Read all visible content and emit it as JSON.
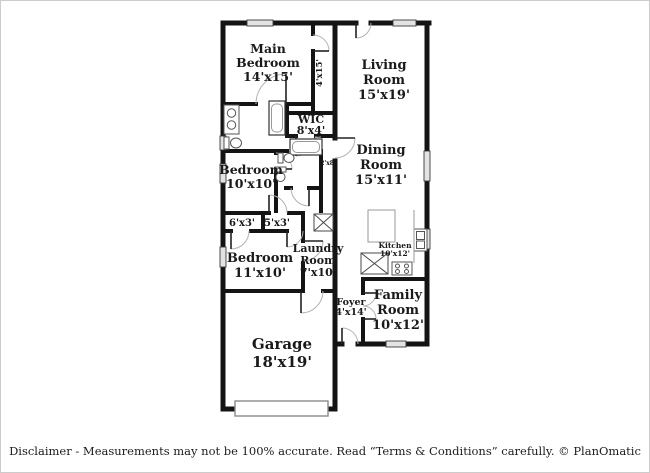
{
  "rooms": {
    "main_bedroom": {
      "line1": "Main",
      "line2": "Bedroom",
      "dims": "14'x15'"
    },
    "hall_top": {
      "dims": "4'x15'"
    },
    "living": {
      "line1": "Living",
      "line2": "Room",
      "dims": "15'x19'"
    },
    "wic": {
      "line1": "WIC",
      "dims": "8'x4'"
    },
    "hall_mid": {
      "dims": "2'x8'"
    },
    "dining": {
      "line1": "Dining",
      "line2": "Room",
      "dims": "15'x11'"
    },
    "bedroom2": {
      "line1": "Bedroom",
      "dims": "10'x10'"
    },
    "closet1": {
      "dims": "6'x3'"
    },
    "closet2": {
      "dims": "5'x3'"
    },
    "bedroom3": {
      "line1": "Bedroom",
      "dims": "11'x10'"
    },
    "laundry": {
      "line1": "Laundry",
      "line2": "Room",
      "dims": "7'x10'"
    },
    "kitchen": {
      "line1": "Kitchen",
      "dims": "10'x12'"
    },
    "foyer": {
      "line1": "Foyer",
      "dims": "4'x14'"
    },
    "family": {
      "line1": "Family",
      "line2": "Room",
      "dims": "10'x12'"
    },
    "garage": {
      "line1": "Garage",
      "dims": "18'x19'"
    }
  },
  "fixtures": [
    "vanity-double-sink",
    "toilet",
    "bathtub",
    "bathtub",
    "pedestal-sink",
    "toilet",
    "utility-closet",
    "kitchen-island",
    "pantry-closet",
    "stove",
    "kitchen-sink",
    "garage-door",
    "front-door"
  ],
  "colors": {
    "wall": "#141414",
    "window": "#e3e3e3",
    "fixture": "#555555",
    "arc": "#b3b3b3",
    "text": "#1a1a1a"
  },
  "footer": {
    "disclaimer": "Disclaimer - Measurements may not be 100% accurate. Read “Terms & Conditions” carefully. © PlanOmatic"
  }
}
